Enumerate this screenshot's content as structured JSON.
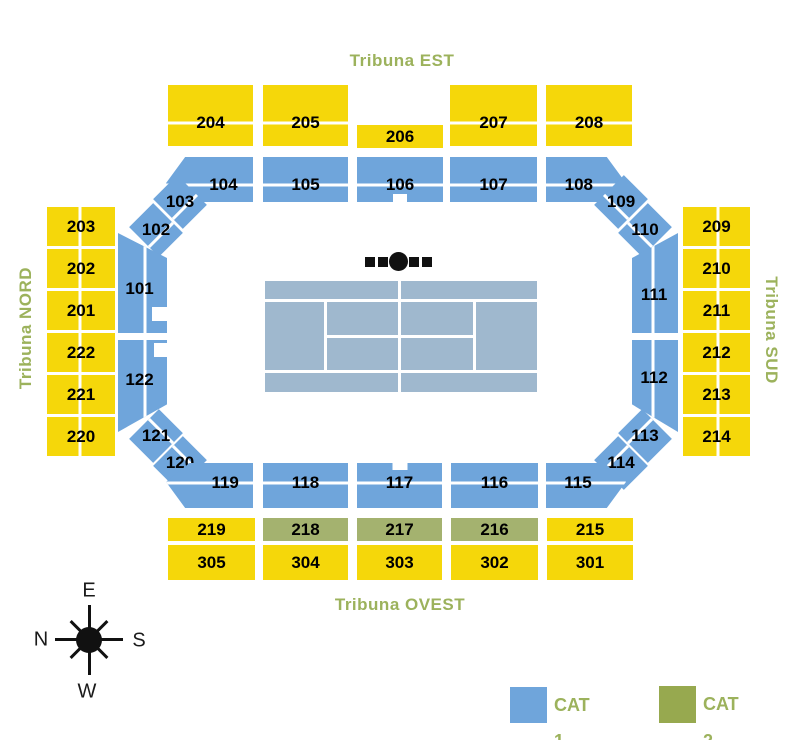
{
  "labels": {
    "est": "Tribuna EST",
    "nord": "Tribuna NORD",
    "sud": "Tribuna SUD",
    "ovest": "Tribuna OVEST"
  },
  "legend": {
    "cat1_label": "CAT 1",
    "cat2_label": "CAT 2"
  },
  "compass": {
    "top": "E",
    "left": "N",
    "right": "S",
    "bottom": "W"
  },
  "colors": {
    "cat1": "#6FA5DB",
    "cat2": "#A4B26F",
    "tribune": "#F5D70A",
    "court": "#9FB8CE",
    "olive_text": "#9CB25C",
    "legend_cat2": "#97A94F"
  },
  "sections": [
    {
      "label": "204",
      "cat": "tribune",
      "x": 168,
      "y": 85,
      "w": 85,
      "h": 61,
      "div": "h62"
    },
    {
      "label": "205",
      "cat": "tribune",
      "x": 263,
      "y": 85,
      "w": 85,
      "h": 61,
      "div": "h62"
    },
    {
      "label": "206",
      "cat": "tribune",
      "x": 357,
      "y": 125,
      "w": 86,
      "h": 23
    },
    {
      "label": "207",
      "cat": "tribune",
      "x": 450,
      "y": 85,
      "w": 87,
      "h": 61,
      "div": "h62"
    },
    {
      "label": "208",
      "cat": "tribune",
      "x": 546,
      "y": 85,
      "w": 86,
      "h": 61,
      "div": "h62"
    },
    {
      "label": "104",
      "cat": "cat1",
      "x": 166,
      "y": 157,
      "w": 87,
      "h": 45,
      "div": "h62",
      "clip": "polygon(22% 0,100% 0,100% 100%,27% 100%,0 58%)",
      "lx": 66
    },
    {
      "label": "105",
      "cat": "cat1",
      "x": 263,
      "y": 157,
      "w": 85,
      "h": 45,
      "div": "h62"
    },
    {
      "label": "106",
      "cat": "cat1",
      "x": 357,
      "y": 157,
      "w": 86,
      "h": 45,
      "div": "h62",
      "notch": "nb"
    },
    {
      "label": "107",
      "cat": "cat1",
      "x": 450,
      "y": 157,
      "w": 87,
      "h": 45,
      "div": "h62"
    },
    {
      "label": "108",
      "cat": "cat1",
      "x": 546,
      "y": 157,
      "w": 80,
      "h": 45,
      "div": "h62",
      "clip": "polygon(0 0,76% 0,100% 58%,72% 100%,0 100%)",
      "lx": 41
    },
    {
      "label": "103",
      "cat": "cat1",
      "x": 163,
      "y": 181,
      "w": 34,
      "h": 42,
      "rot": -45,
      "div": "h67"
    },
    {
      "label": "102",
      "cat": "cat1",
      "x": 139,
      "y": 209,
      "w": 34,
      "h": 42,
      "rot": -45,
      "div": "h67"
    },
    {
      "label": "109",
      "cat": "cat1",
      "x": 604,
      "y": 181,
      "w": 34,
      "h": 42,
      "rot": 45,
      "div": "h67"
    },
    {
      "label": "110",
      "cat": "cat1",
      "x": 628,
      "y": 209,
      "w": 34,
      "h": 42,
      "rot": 45,
      "div": "h67"
    },
    {
      "label": "101",
      "cat": "cat1",
      "x": 118,
      "y": 233,
      "w": 49,
      "h": 100,
      "div": "v55",
      "clip": "polygon(0 0,100% 25%,100% 100%,0 100%)",
      "notch": "nrb",
      "lx": 44,
      "ly": 56
    },
    {
      "label": "122",
      "cat": "cat1",
      "x": 118,
      "y": 340,
      "w": 49,
      "h": 92,
      "div": "v55",
      "clip": "polygon(0 0,100% 0,100% 70%,0 100%)",
      "notch": "nrt",
      "lx": 44,
      "ly": 43
    },
    {
      "label": "111",
      "cat": "cat1",
      "x": 632,
      "y": 233,
      "w": 46,
      "h": 100,
      "div": "v45",
      "clip": "polygon(0 25%,100% 0,100% 100%,0 100%)",
      "lx": 48,
      "ly": 62
    },
    {
      "label": "112",
      "cat": "cat1",
      "x": 632,
      "y": 340,
      "w": 46,
      "h": 92,
      "div": "v45",
      "clip": "polygon(0 0,100% 0,100% 100%,0 70%)",
      "lx": 48,
      "ly": 41
    },
    {
      "label": "121",
      "cat": "cat1",
      "x": 139,
      "y": 415,
      "w": 34,
      "h": 42,
      "rot": 45,
      "div": "h33"
    },
    {
      "label": "120",
      "cat": "cat1",
      "x": 163,
      "y": 442,
      "w": 34,
      "h": 42,
      "rot": 45,
      "div": "h33"
    },
    {
      "label": "113",
      "cat": "cat1",
      "x": 628,
      "y": 415,
      "w": 34,
      "h": 42,
      "rot": -45,
      "div": "h33"
    },
    {
      "label": "114",
      "cat": "cat1",
      "x": 604,
      "y": 442,
      "w": 34,
      "h": 42,
      "rot": -45,
      "div": "h33"
    },
    {
      "label": "119",
      "cat": "cat1",
      "x": 166,
      "y": 463,
      "w": 87,
      "h": 45,
      "div": "h44",
      "clip": "polygon(27% 0,100% 0,100% 100%,22% 100%,0 42%)",
      "lx": 68
    },
    {
      "label": "118",
      "cat": "cat1",
      "x": 263,
      "y": 463,
      "w": 85,
      "h": 45,
      "div": "h44"
    },
    {
      "label": "117",
      "cat": "cat1",
      "x": 357,
      "y": 463,
      "w": 85,
      "h": 45,
      "div": "h44",
      "notch": "nt"
    },
    {
      "label": "116",
      "cat": "cat1",
      "x": 451,
      "y": 463,
      "w": 87,
      "h": 45,
      "div": "h44"
    },
    {
      "label": "115",
      "cat": "cat1",
      "x": 546,
      "y": 463,
      "w": 80,
      "h": 45,
      "div": "h44",
      "clip": "polygon(0 0,73% 0,100% 42%,76% 100%,0 100%)",
      "lx": 40
    },
    {
      "label": "203",
      "cat": "tribune",
      "x": 47,
      "y": 207,
      "w": 68,
      "h": 39,
      "div": "v48"
    },
    {
      "label": "202",
      "cat": "tribune",
      "x": 47,
      "y": 249,
      "w": 68,
      "h": 39,
      "div": "v48"
    },
    {
      "label": "201",
      "cat": "tribune",
      "x": 47,
      "y": 291,
      "w": 68,
      "h": 39,
      "div": "v48"
    },
    {
      "label": "222",
      "cat": "tribune",
      "x": 47,
      "y": 333,
      "w": 68,
      "h": 39,
      "div": "v48"
    },
    {
      "label": "221",
      "cat": "tribune",
      "x": 47,
      "y": 375,
      "w": 68,
      "h": 39,
      "div": "v48"
    },
    {
      "label": "220",
      "cat": "tribune",
      "x": 47,
      "y": 417,
      "w": 68,
      "h": 39,
      "div": "v48"
    },
    {
      "label": "209",
      "cat": "tribune",
      "x": 683,
      "y": 207,
      "w": 67,
      "h": 39,
      "div": "v52"
    },
    {
      "label": "210",
      "cat": "tribune",
      "x": 683,
      "y": 249,
      "w": 67,
      "h": 39,
      "div": "v52"
    },
    {
      "label": "211",
      "cat": "tribune",
      "x": 683,
      "y": 291,
      "w": 67,
      "h": 39,
      "div": "v52"
    },
    {
      "label": "212",
      "cat": "tribune",
      "x": 683,
      "y": 333,
      "w": 67,
      "h": 39,
      "div": "v52"
    },
    {
      "label": "213",
      "cat": "tribune",
      "x": 683,
      "y": 375,
      "w": 67,
      "h": 39,
      "div": "v52"
    },
    {
      "label": "214",
      "cat": "tribune",
      "x": 683,
      "y": 417,
      "w": 67,
      "h": 39,
      "div": "v52"
    },
    {
      "label": "219",
      "cat": "tribune",
      "x": 168,
      "y": 518,
      "w": 87,
      "h": 23
    },
    {
      "label": "218",
      "cat": "cat2",
      "x": 263,
      "y": 518,
      "w": 85,
      "h": 23
    },
    {
      "label": "217",
      "cat": "cat2",
      "x": 357,
      "y": 518,
      "w": 85,
      "h": 23
    },
    {
      "label": "216",
      "cat": "cat2",
      "x": 451,
      "y": 518,
      "w": 87,
      "h": 23
    },
    {
      "label": "215",
      "cat": "tribune",
      "x": 547,
      "y": 518,
      "w": 86,
      "h": 23
    },
    {
      "label": "305",
      "cat": "tribune",
      "x": 168,
      "y": 545,
      "w": 87,
      "h": 35
    },
    {
      "label": "304",
      "cat": "tribune",
      "x": 263,
      "y": 545,
      "w": 85,
      "h": 35
    },
    {
      "label": "303",
      "cat": "tribune",
      "x": 357,
      "y": 545,
      "w": 85,
      "h": 35
    },
    {
      "label": "302",
      "cat": "tribune",
      "x": 451,
      "y": 545,
      "w": 87,
      "h": 35
    },
    {
      "label": "301",
      "cat": "tribune",
      "x": 547,
      "y": 545,
      "w": 86,
      "h": 35
    }
  ]
}
